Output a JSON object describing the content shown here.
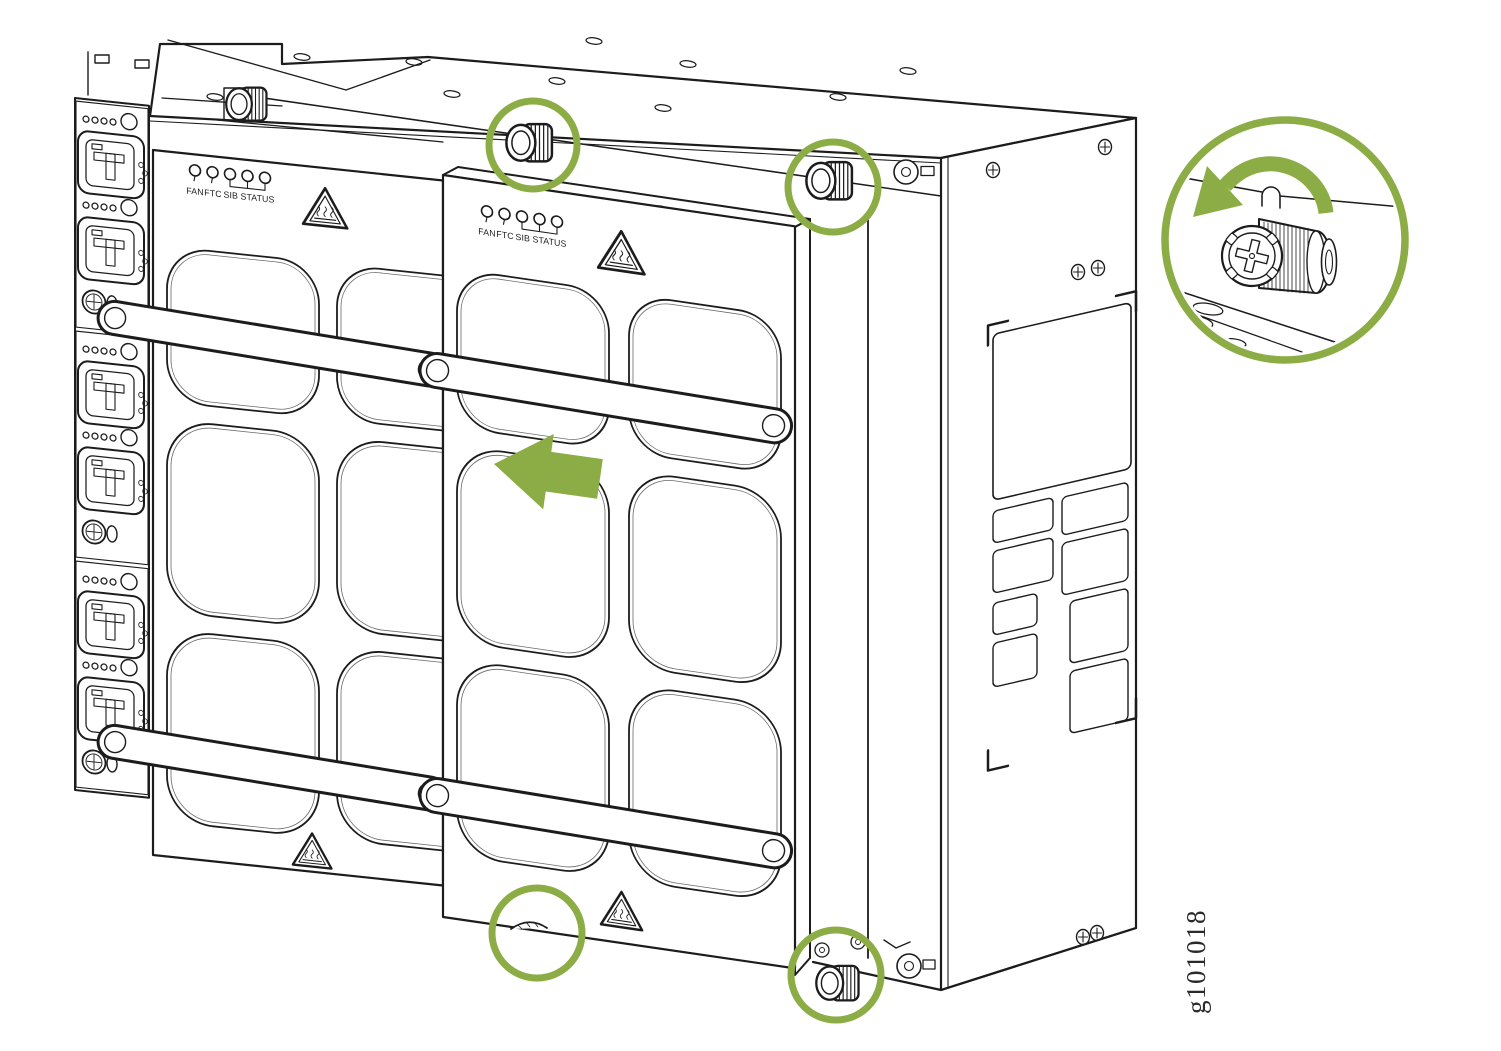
{
  "figure": {
    "graphic_id": "g101018"
  },
  "colors": {
    "highlight_green": "#8CAD45",
    "line_black": "#1C1C1C",
    "background": "#FFFFFF"
  },
  "modules": [
    {
      "id": "rear-sib",
      "led_labels": {
        "fan": "FAN",
        "ftc": "FTC",
        "sib_status": "SIB STATUS"
      }
    },
    {
      "id": "front-sib",
      "led_labels": {
        "fan": "FAN",
        "ftc": "FTC",
        "sib_status": "SIB STATUS"
      }
    }
  ],
  "icons": {
    "hot_surface": "hot-surface-warning-icon",
    "thumbscrew": "captive-thumbscrew-icon",
    "highlight_circle": "highlight-circle",
    "removal_arrow": "slide-out-left-arrow-icon",
    "rotation_arrow": "loosen-counterclockwise-arrow-icon",
    "led": "status-led-icon",
    "screw": "phillips-screw-icon",
    "handle": "module-handle",
    "power_inlet": "power-inlet-connector-icon"
  }
}
